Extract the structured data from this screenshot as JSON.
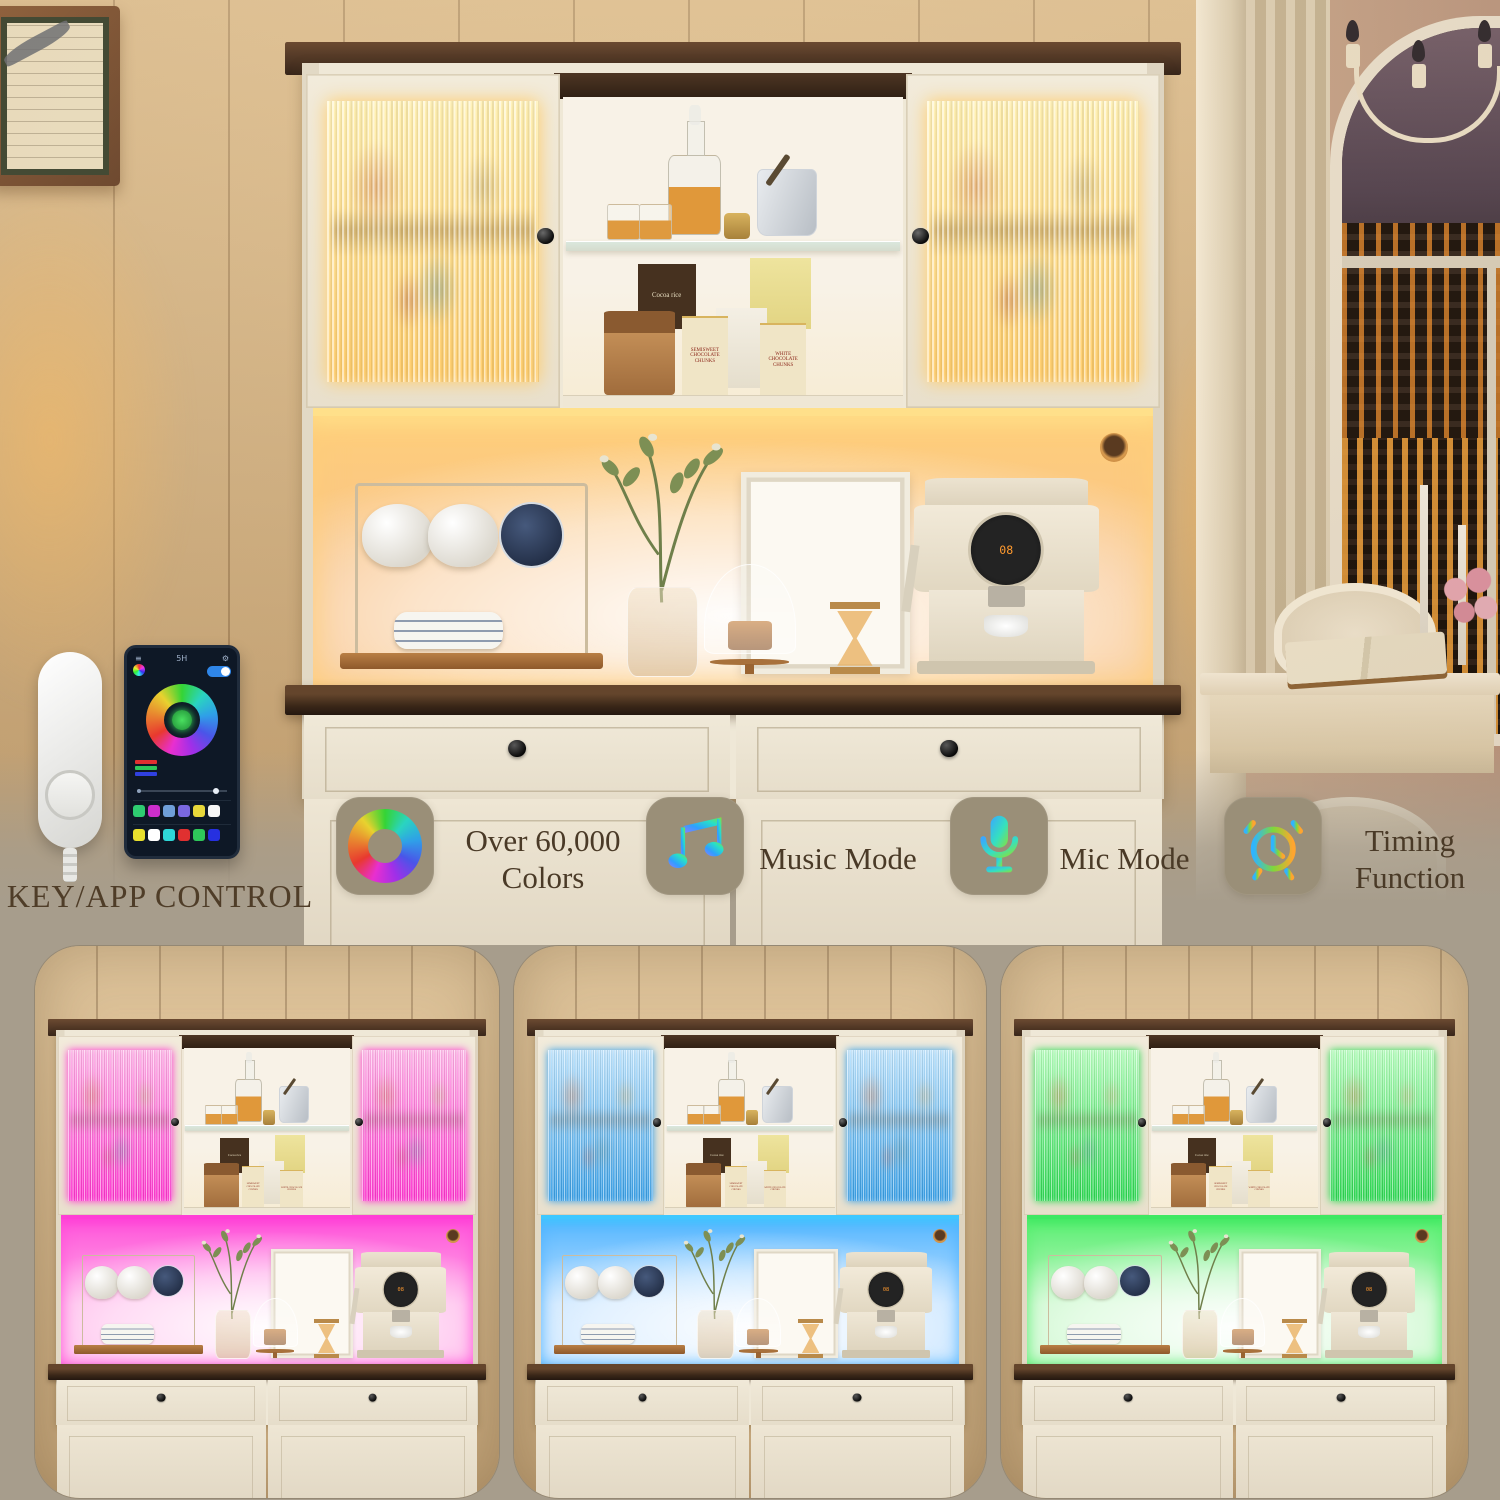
{
  "canvas": {
    "background": "#a79d8c",
    "text_color": "#4a3a27"
  },
  "key_app": {
    "label": "KEY/APP CONTROL",
    "phone": {
      "title": "5H",
      "menu_icon": "≡",
      "gear_icon": "⚙",
      "legend_colors": [
        "#e03030",
        "#2ec85a",
        "#3040e0"
      ],
      "swatch_row1": [
        "#2ecc71",
        "#cc2ecc",
        "#6f9fd8",
        "#7a68e0",
        "#e8d83a",
        "#f5f5f5"
      ],
      "swatch_row2": [
        "#e8e02e",
        "#ffffff",
        "#2ed8d8",
        "#e03030",
        "#2ec85a",
        "#2630e0"
      ]
    }
  },
  "features": [
    {
      "icon": "color-wheel-icon",
      "line1": "Over 60,000",
      "line2": "Colors"
    },
    {
      "icon": "music-note-icon",
      "line1": "Music Mode",
      "line2": ""
    },
    {
      "icon": "microphone-icon",
      "line1": "Mic Mode",
      "line2": ""
    },
    {
      "icon": "alarm-clock-icon",
      "line1": "Timing",
      "line2": "Function"
    }
  ],
  "products": {
    "cocoa_box": "Cocoa rice",
    "semisweet_box": "SEMISWEET CHOCOLATE CHUNKS",
    "white_box": "WHITE CHOCOLATE CHUNKS",
    "coffee_display": "08"
  },
  "variants": [
    {
      "name": "warm-white",
      "led": "#ffe08a",
      "glass_top": "#fff0b0",
      "glass_bottom": "#ffcc68",
      "backsplash_top": "#ffcf7a",
      "backsplash_edge": "#f8c288"
    },
    {
      "name": "pink",
      "led": "#ff3fd6",
      "glass_top": "#ffaee8",
      "glass_bottom": "#ff2fd0",
      "backsplash_top": "#ff4fd9",
      "backsplash_edge": "#ffb0e8"
    },
    {
      "name": "blue",
      "led": "#3fc8ff",
      "glass_top": "#b8e2ff",
      "glass_bottom": "#2f9ce8",
      "backsplash_top": "#4fb4ff",
      "backsplash_edge": "#bfe0ff"
    },
    {
      "name": "green",
      "led": "#3fe862",
      "glass_top": "#b0ffba",
      "glass_bottom": "#23d84d",
      "backsplash_top": "#55ee6e",
      "backsplash_edge": "#c2f7c4"
    }
  ]
}
